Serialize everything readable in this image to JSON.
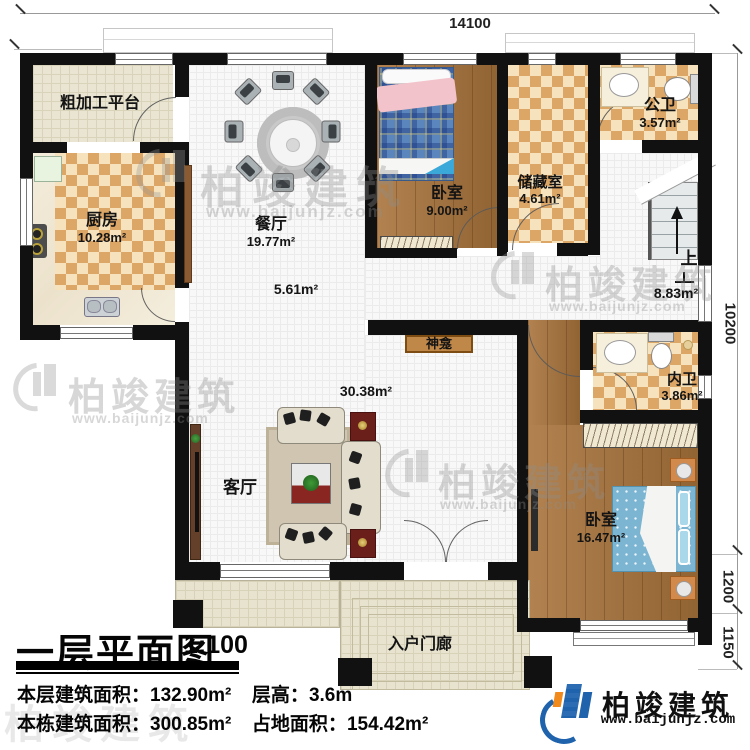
{
  "dimensions": {
    "top_width": "14100",
    "right_total": "10200",
    "right_bed": "1200",
    "right_porch": "1150"
  },
  "rooms": {
    "platform": {
      "name": "粗加工平台"
    },
    "kitchen": {
      "name": "厨房",
      "area": "10.28m²"
    },
    "dining": {
      "name": "餐厅",
      "area": "19.77m²"
    },
    "bedroom_top": {
      "name": "卧室",
      "area": "9.00m²"
    },
    "storage": {
      "name": "储藏室",
      "area": "4.61m²"
    },
    "public_bath": {
      "name": "公卫",
      "area": "3.57m²"
    },
    "stair_hall": {
      "up": "上",
      "area": "8.83m²"
    },
    "hallway": {
      "area": "5.61m²"
    },
    "shrine": {
      "name": "神龛"
    },
    "private_bath": {
      "name": "内卫",
      "area": "3.86m²"
    },
    "living": {
      "name": "客厅",
      "area": "30.38m²"
    },
    "bedroom_master": {
      "name": "卧室",
      "area": "16.47m²"
    },
    "porch": {
      "name": "入户门廊"
    }
  },
  "titleblock": {
    "title": "一层平面图",
    "scale": "1:100",
    "floor_area_label": "本层建筑面积：",
    "floor_area_value": "132.90m²",
    "story_height_label": "层高：",
    "story_height_value": "3.6m",
    "total_area_label": "本栋建筑面积：",
    "total_area_value": "300.85m²",
    "footprint_label": "占地面积：",
    "footprint_value": "154.42m²"
  },
  "brand": {
    "name": "柏竣建筑",
    "website": "www.baijunjz.com"
  },
  "watermark": {
    "name": "柏竣建筑",
    "website": "www.baijunjz.com"
  },
  "colors": {
    "wall": "#111111",
    "checker_dark": "#dca667",
    "checker_light": "#f6e3bd",
    "wood": "#a9743c",
    "floor_grid": "#f8f8f8",
    "porch": "#e7e3cf",
    "brand_blue": "#1f63ad",
    "brand_orange": "#f08a1d",
    "bed_blue": "#7cb5d2"
  }
}
